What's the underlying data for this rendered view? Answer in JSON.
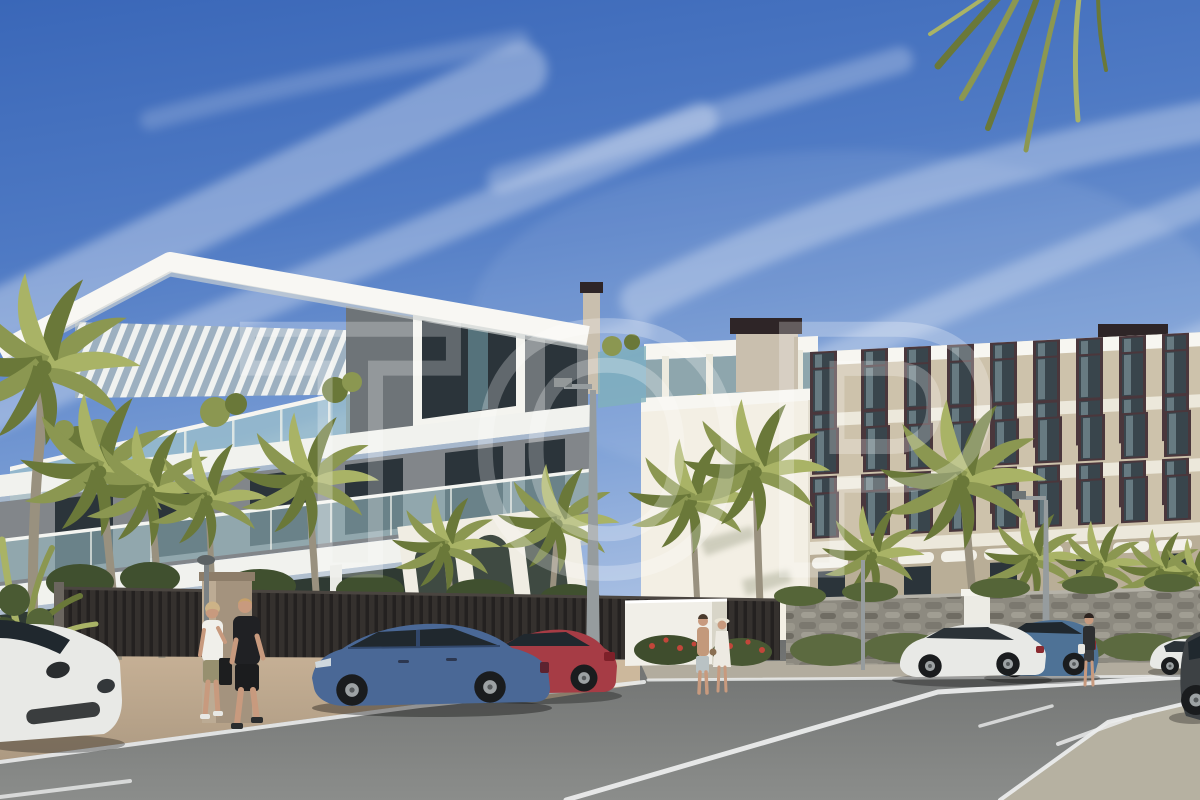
{
  "watermark": {
    "text": "TOP",
    "opacity": "0.26"
  },
  "scene": {
    "type": "architectural-exterior-render",
    "buildings": [
      "white-modern-apartment-left",
      "beige-apartment-right"
    ],
    "vehicles": [
      "white-porsche",
      "red-sedan",
      "blue-sedan",
      "blue-suv",
      "white-sedan",
      "white-hatchback",
      "dark-car"
    ],
    "pedestrians": 5,
    "palm_trees": 15
  },
  "palette": {
    "sky_top": "#3a67b8",
    "sky_mid": "#5d86c9",
    "sky_pale": "#b3c7e6",
    "cloud": "#ffffff",
    "roof_white": "#f7f6f1",
    "white_band": "#f1f2ee",
    "left_wall": "#82868a",
    "left_wall_dark": "#6e7478",
    "window_dark": "#2b343a",
    "glass_teal": "#9fc3ca",
    "glass_deep": "#7fb0bc",
    "right_wall": "#cdc2ab",
    "right_band": "#ece8db",
    "frame_brown": "#4a373c",
    "right_glass": "#39454c",
    "right_glass_hi": "#8ea6ad",
    "side_wall": "#f3efe4",
    "penthouse_white": "#efece2",
    "chimney_dark": "#2e2527",
    "chimney_beige": "#c9bfae",
    "palm_green": "#8b9751",
    "palm_dark": "#6a7839",
    "palm_light": "#a9b366",
    "trunk": "#99917f",
    "hedge": "#5c6a40",
    "bush_dark": "#40502f",
    "flower_red": "#c2463a",
    "fence_dark": "#242120",
    "stone": "#8d8a80",
    "road": "#7e807e",
    "marking": "#ebecec",
    "sidewalk": "#bda98b",
    "sidewalk_light": "#cdb99d",
    "island": "#b6b1a1",
    "car_blue": "#4a6896",
    "car_red": "#a63c45",
    "car_white": "#e8e9e6",
    "suv_blue": "#4e7296",
    "car_dark": "#3d4144",
    "glass_dark": "#20282e",
    "skin": "#c89a7e",
    "tee_white": "#f0efea",
    "tee_black": "#202124",
    "pole_gray": "#969c9e",
    "watermark_white": "#ffffff"
  }
}
